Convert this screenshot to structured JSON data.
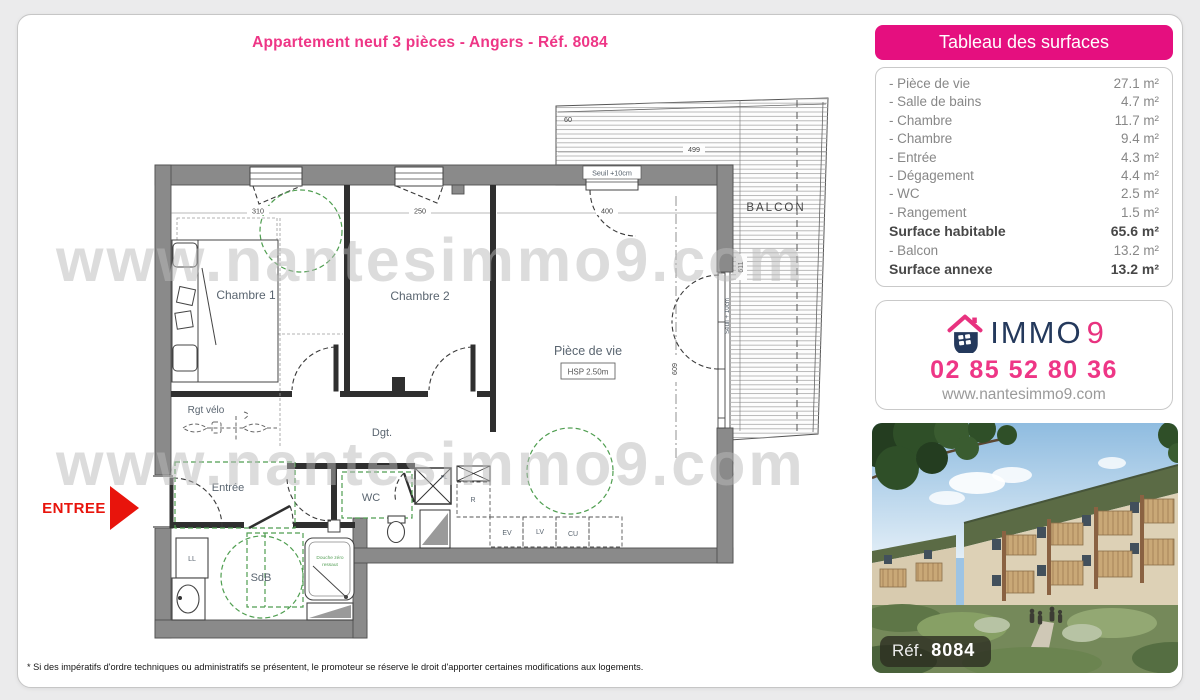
{
  "page": {
    "title": "Appartement neuf 3 pièces - Angers - Réf. 8084",
    "disclaimer": "* Si des impératifs d'ordre techniques ou administratifs se présentent, le promoteur se réserve le droit d'apporter certaines modifications aux logements."
  },
  "colors": {
    "accent_pink": "#ee3686",
    "header_pink": "#e50f7f",
    "navy": "#24395c",
    "entry_red": "#e8140c",
    "wall_gray": "#8a8a8a",
    "green_dash": "#4f9e50"
  },
  "surfaces": {
    "header": "Tableau des surfaces",
    "rows": [
      {
        "label": "- Pièce de vie",
        "value": "27.1 m²"
      },
      {
        "label": "- Salle de bains",
        "value": "4.7 m²"
      },
      {
        "label": "- Chambre",
        "value": "11.7 m²"
      },
      {
        "label": "- Chambre",
        "value": "9.4 m²"
      },
      {
        "label": "- Entrée",
        "value": "4.3 m²"
      },
      {
        "label": "- Dégagement",
        "value": "4.4 m²"
      },
      {
        "label": "- WC",
        "value": "2.5 m²"
      },
      {
        "label": "- Rangement",
        "value": "1.5 m²"
      },
      {
        "label": "Surface habitable",
        "value": "65.6 m²"
      },
      {
        "label": "- Balcon",
        "value": "13.2 m²"
      },
      {
        "label": "Surface annexe",
        "value": "13.2 m²"
      }
    ]
  },
  "immo": {
    "brand_immo": "IMMO",
    "brand_9": "9",
    "phone": "02 85 52 80 36",
    "website": "www.nantesimmo9.com"
  },
  "photo": {
    "ref_label": "Réf.",
    "ref_value": "8084"
  },
  "plan": {
    "watermark": "www.nantesimmo9.com",
    "entree_marker": "ENTREE",
    "labels": {
      "chambre1": "Chambre 1",
      "chambre2": "Chambre 2",
      "piece_de_vie": "Pièce de vie",
      "hsp": "HSP 2.50m",
      "balcon": "BALCON",
      "dgt": "Dgt.",
      "entree": "Entrée",
      "wc": "WC",
      "sdb": "SdB",
      "rgt_velo": "Rgt vélo",
      "ll": "LL",
      "r": "R",
      "pl": "PL",
      "ev": "EV",
      "lv": "LV",
      "cu": "CU",
      "douche_line1": "Douche zéro",
      "douche_line2": "ressaut",
      "seuil_top": "Seuil +10cm",
      "seuil_right": "Seuil + 10cm"
    },
    "dims": {
      "d310": "310",
      "d250": "250",
      "d400": "400",
      "d499": "499",
      "d60": "60",
      "d611": "611",
      "d609": "609"
    }
  }
}
